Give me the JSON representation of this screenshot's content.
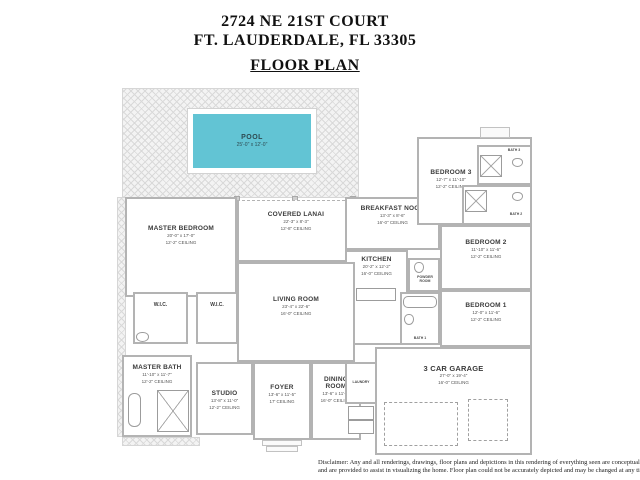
{
  "header": {
    "address_line1": "2724 NE 21ST COURT",
    "address_line2": "FT. LAUDERDALE, FL 33305",
    "plan_title": "FLOOR PLAN"
  },
  "pool": {
    "name": "POOL",
    "dims": "25'-0\" x 12'-0\""
  },
  "rooms": {
    "master_bedroom": {
      "name": "MASTER BEDROOM",
      "dims": "20'-0\" x 17'-0\"",
      "ceiling": "12'-2\" CEILING"
    },
    "covered_lanai": {
      "name": "COVERED LANAI",
      "dims": "22'-3\" x 8'-3\"",
      "ceiling": "12'-8\" CEILING"
    },
    "breakfast_nook": {
      "name": "BREAKFAST NOOK",
      "dims": "13'-3\" x 8'-6\"",
      "ceiling": "16'-0\" CEILING"
    },
    "kitchen": {
      "name": "KITCHEN",
      "dims": "20'-2\" x 12'-2\"",
      "ceiling": "16'-0\" CEILING"
    },
    "living_room": {
      "name": "LIVING ROOM",
      "dims": "23'-4\" x 22'-6\"",
      "ceiling": "16'-0\" CEILING"
    },
    "bedroom3": {
      "name": "BEDROOM 3",
      "dims": "12'-7\" x 11'-10\"",
      "ceiling": "12'-2\" CEILING"
    },
    "bedroom2": {
      "name": "BEDROOM 2",
      "dims": "11'-10\" x 11'-6\"",
      "ceiling": "12'-2\" CEILING"
    },
    "bedroom1": {
      "name": "BEDROOM 1",
      "dims": "12'-0\" x 11'-6\"",
      "ceiling": "12'-2\" CEILING"
    },
    "master_bath": {
      "name": "MASTER BATH",
      "dims": "11'-10\" x 11'-7\"",
      "ceiling": "12'-2\" CEILING"
    },
    "studio": {
      "name": "STUDIO",
      "dims": "13'-8\" x 11'-0\"",
      "ceiling": "12'-2\" CEILING"
    },
    "foyer": {
      "name": "FOYER",
      "dims": "13'-6\" x 11'-5\"",
      "ceiling": "17' CEILING"
    },
    "dining_room": {
      "name": "DINING ROOM",
      "dims": "13'-6\" x 11'-5\"",
      "ceiling": "16'-0\" CEILING"
    },
    "garage": {
      "name": "3 CAR GARAGE",
      "dims": "27'-0\" x 19'-4\"",
      "ceiling": "16'-0\" CEILING"
    }
  },
  "small_rooms": {
    "wic_left": "W.I.C.",
    "wic_right": "W.I.C.",
    "bath3": "BATH 3",
    "bath2": "BATH 2",
    "bath1": "BATH 1",
    "powder": "POWDER ROOM",
    "laundry": "LAUNDRY"
  },
  "disclaimer": {
    "line1": "Disclaimer: Any and all renderings, drawings, floor plans and depictions in this rendering of everything seen are conceptual",
    "line2": "and are provided to assist in visualizing the home. Floor plan could not be accurately depicted and may be changed at any time."
  },
  "colors": {
    "pool": "#62c4d4",
    "wall": "#b3b3b3",
    "deck": "#f3f3f3"
  }
}
